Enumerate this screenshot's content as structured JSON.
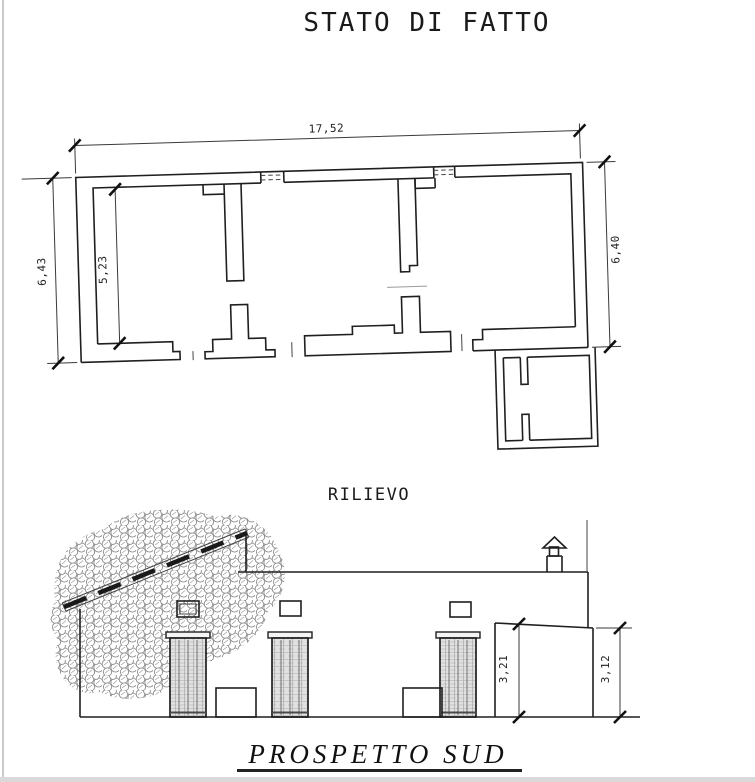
{
  "titles": {
    "main": "STATO DI FATTO",
    "survey": "RILIEVO",
    "elevation": "PROSPETTO SUD"
  },
  "floor_plan": {
    "dim_total_width": "17,52",
    "dim_total_height_left": "6,43",
    "dim_interior_height": "5,23",
    "dim_total_height_right": "6,40"
  },
  "elevation": {
    "dim_annex_height_left": "3,21",
    "dim_annex_height_right": "3,12"
  },
  "colors": {
    "ink": "#1f1f1f",
    "foliage_gray": "#8d8d8d",
    "page_edge": "#bdbdbd"
  }
}
